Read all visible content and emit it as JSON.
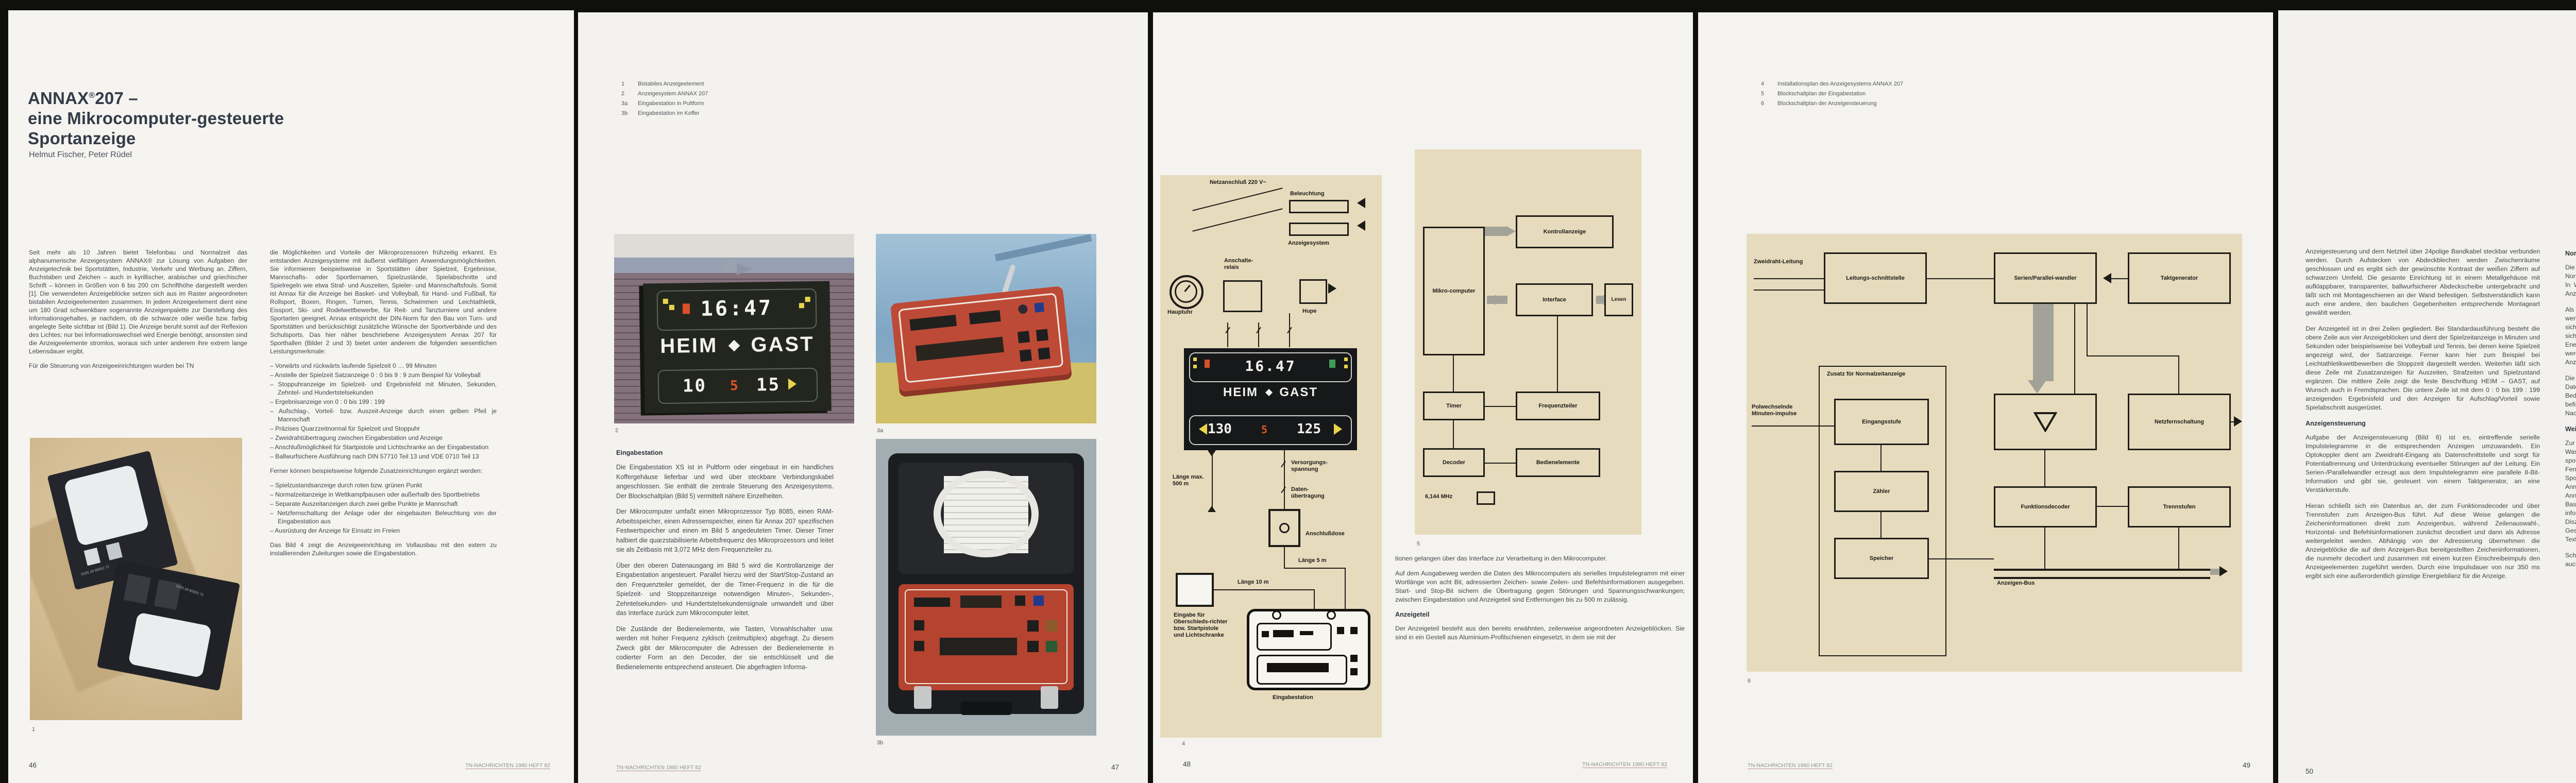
{
  "journal_footer": "TN-NACHRICHTEN 1980 HEFT 82",
  "colors": {
    "page_bg": "#f4f3f0",
    "diagram_bg": "#e7dbbd",
    "accent_yellow": "#e7d44a",
    "accent_red": "#d8502c",
    "accent_green": "#3f9e55",
    "console_red": "#b94a35",
    "bob_board_blue": "#2d4e8e",
    "body_text": "#42474d"
  },
  "p46": {
    "number": "46",
    "title": {
      "brand": "ANNAX",
      "reg": "®",
      "rest": "207 –",
      "line2": "eine Mikrocomputer-gesteuerte",
      "line3": "Sportanzeige"
    },
    "authors": "Helmut Fischer, Peter Rüdel",
    "col1": {
      "p1": "Seit mehr als 10 Jahren bietet Telefonbau und Normalzeit das alphanumerische Anzeigesystem ANNAX® zur Lösung von Aufgaben der Anzeigetechnik bei Sportstätten, Industrie, Verkehr und Werbung an. Ziffern, Buchstaben und Zeichen – auch in kyrillischer, arabischer und griechischer Schrift – können in Größen von 6 bis 200 cm Schrifthöhe dargestellt werden [1]. Die verwendeten Anzeigeblöcke setzen sich aus im Raster angeordneten bistabilen Anzeigeelementen zusammen. In jedem Anzeigeelement dient eine um 180 Grad schwenkbare sogenannte Anzeigenpalette zur Darstellung des Informationsgehaltes, je nachdem, ob die schwarze oder weiße bzw. farbig angelegte Seite sichtbar ist (Bild 1). Die Anzeige beruht somit auf der Reflexion des Lichtes; nur bei Informationswechsel wird Energie benötigt, ansonsten sind die Anzeigeelemente stromlos, woraus sich unter anderem ihre extrem lange Lebensdauer ergibt.",
      "p2": "Für die Steuerung von Anzeigeeinrichtungen wurden bei TN"
    },
    "fig1": {
      "caption": "1",
      "cube_label": "0165.18 90052 72"
    },
    "col2": {
      "p1": "die Möglichkeiten und Vorteile der Mikroprozessoren frühzeitig erkannt. Es entstanden Anzeigesysteme mit äußerst vielfältigen Anwendungsmöglichkeiten. Sie informieren beispielsweise in Sportstätten über Spielzeit, Ergebnisse, Mannschafts- oder Sportlernamen, Spielzustände, Spielabschnitte und Spielregeln wie etwa Straf- und Auszeiten, Spieler- und Mannschaftsfouls. Somit ist Annax für die Anzeige bei Basket- und Volleyball, für Hand- und Fußball, für Rollsport, Boxen, Ringen, Turnen, Tennis, Schwimmen und Leichtathletik, Eissport, Ski- und Rodelwettbewerbe, für Reit- und Tanzturniere und andere Sportarten geeignet. Annax entspricht der DIN-Norm für den Bau von Turn- und Sportstätten und berücksichtigt zusätzliche Wünsche der Sportverbände und des Schulsports. Das hier näher beschriebene Anzeigesystem Annax 207 für Sporthallen (Bilder 2 und 3) bietet unter anderem die folgenden wesentlichen Leistungsmerkmale:",
      "features": [
        "– Vorwärts und rückwärts laufende Spielzeit 0 … 99 Minuten",
        "– Anstelle der Spielzeit Satzanzeige 0 : 0 bis 9 : 9 zum Beispiel für Volleyball",
        "– Stoppuhranzeige im Spielzeit- und Ergebnisfeld mit Minuten, Sekunden, Zehntel- und Hundertstelsekunden",
        "– Ergebnisanzeige von 0 : 0 bis 199 : 199",
        "– Aufschlag-, Vorteil- bzw. Auszeit-Anzeige durch einen gelben Pfeil je Mannschaft",
        "– Präzises Quarzzeitnormal für Spielzeit und Stoppuhr",
        "– Zweidrahtübertragung zwischen Eingabestation und Anzeige",
        "– Anschlußmöglichkeit für Startpistole und Lichtschranke an der Eingabestation",
        "– Ballwurfsichere Ausführung nach DIN 57710 Teil 13 und VDE 0710 Teil 13"
      ],
      "mid": "Ferner können beispielsweise folgende Zusatzeinrichtungen ergänzt werden:",
      "extras": [
        "– Spielzustandsanzeige durch roten bzw. grünen Punkt",
        "– Normalzeitanzeige in Wettkampfpausen oder außerhalb des Sportbetriebs",
        "– Separate Auszeitanzeigen durch zwei gelbe Punkte je Mannschaft",
        "– Netzfernschaltung der Anlage oder der eingebauten Beleuchtung von der Eingabestation aus",
        "– Ausrüstung der Anzeige für Einsatz im Freien"
      ],
      "last": "Das Bild 4 zeigt die Anzeigeeinrichtung im Vollausbau mit den extern zu installierenden Zuleitungen sowie die Eingabestation."
    }
  },
  "p47": {
    "number": "47",
    "captions": [
      {
        "num": "1",
        "text": "Bistabiles Anzeigeelement"
      },
      {
        "num": "2",
        "text": "Anzeigesystem ANNAX 207"
      },
      {
        "num": "3a",
        "text": "Eingabestation in Pultform"
      },
      {
        "num": "3b",
        "text": "Eingabestation im Koffer"
      }
    ],
    "fig2": {
      "caption": "2",
      "time": "16:47",
      "heim": "HEIM",
      "gast": "GAST",
      "s1": "10",
      "mid": "5",
      "s2": "15"
    },
    "fig3a": {
      "caption": "3a"
    },
    "fig3b": {
      "caption": "3b"
    },
    "heading": "Eingabestation",
    "col": {
      "p1": "Die Eingabestation XS ist in Pultform oder eingebaut in ein handliches Koffergehäuse lieferbar und wird über steckbare Verbindungskabel angeschlossen. Sie enthält die zentrale Steuerung des Anzeigesystems. Der Blockschaltplan (Bild 5) vermittelt nähere Einzelheiten.",
      "p2": "Der Mikrocomputer umfaßt einen Mikroprozessor Typ 8085, einen RAM-Arbeitsspeicher, einen Adressenspeicher, einen für Annax 207 spezifischen Festwertspeicher und einen im Bild 5 angedeuteten Timer. Dieser Timer halbiert die quarzstabilisierte Arbeitsfrequenz des Mikroprozessors und leitet sie als Zeitbasis mit 3,072 MHz dem Frequenzteiler zu.",
      "p3": "Über den oberen Datenausgang im Bild 5 wird die Kontrollanzeige der Eingabestation angesteuert. Parallel hierzu wird der Start/Stop-Zustand an den Frequenzteiler gemeldet, der die Timer-Frequenz in die für die Spielzeit- und Stoppzeitanzeige notwendigen Minuten-, Sekunden-, Zehntelsekunden- und Hundertstelsekundensignale umwandelt und über das Interface zurück zum Mikrocomputer leitet.",
      "p4": "Die Zustände der Bedienelemente, wie Tasten, Vorwahlschalter usw. werden mit hoher Frequenz zyklisch (zeitmultiplex) abgefragt. Zu diesem Zweck gibt der Mikrocomputer die Adressen der Bedienelemente in codierter Form an den Decoder, der sie entschlüsselt und die Bedienelemente entsprechend ansteuert. Die abgefragten Informa-"
    }
  },
  "p48": {
    "number": "48",
    "fig4": {
      "caption": "4",
      "netz": "Netzanschluß 220 V~",
      "beleuchtung": "Beleuchtung",
      "anzeigesystem": "Anzeigesystem",
      "relais": "Anschalte-relais",
      "hupe": "Hupe",
      "hauptuhr": "Hauptuhr",
      "board": {
        "clock": "16.47",
        "heim": "HEIM",
        "gast": "GAST",
        "s1": "130",
        "mid": "5",
        "s2": "125"
      },
      "laenge500": "Länge max. 500 m",
      "versorgung": "Versorgungs-spannung",
      "daten": "Daten-übertragung",
      "dose": "Anschlußdose",
      "laenge5": "Länge 5 m",
      "laenge10": "Länge 10 m",
      "eingabe": "Eingabe für Oberschieds-richter bzw. Startpistole und Lichtschranke",
      "station": "Eingabestation"
    },
    "fig5": {
      "caption": "5",
      "mikro": "Mikro-computer",
      "kontroll": "Kontrollanzeige",
      "interface": "Interface",
      "lesen": "Lesen",
      "timer": "Timer",
      "freq": "Frequenzteiler",
      "decoder": "Decoder",
      "bedien": "Bedienelemente",
      "quartz": "6,144 MHz"
    },
    "col": {
      "cont": "tionen gelangen über das Interface zur Verarbeitung in den Mikrocomputer.",
      "p2": "Auf dem Ausgabeweg werden die Daten des Mikrocomputers als serielles Impulstelegramm mit einer Wortlänge von acht Bit, adressierten Zeichen- sowie Zeilen- und Befehlsinformationen ausgegeben. Start- und Stop-Bit sichern die Übertragung gegen Störungen und Spannungsschwankungen; zwischen Eingabestation und Anzeigeteil sind Entfernungen bis zu 500 m zulässig.",
      "heading": "Anzeigeteil",
      "p3": "Der Anzeigeteil besteht aus den bereits erwähnten, zeilenweise angeordneten Anzeigeblöcken. Sie sind in ein Gestell aus Aluminium-Profilschienen eingesetzt, in dem sie mit der"
    }
  },
  "p49": {
    "number": "49",
    "captions": [
      {
        "num": "4",
        "text": "Installationsplan des Anzeigesystems ANNAX 207"
      },
      {
        "num": "5",
        "text": "Blockschaltplan der Eingabestation"
      },
      {
        "num": "6",
        "text": "Blockschaltplan der Anzeigensteuerung"
      }
    ],
    "fig6": {
      "caption": "6",
      "zweidraht": "Zweidraht-Leitung",
      "schnittstelle": "Leitungs-schnittstelle",
      "wandler": "Serien/Parallel-wandler",
      "takt": "Taktgenerator",
      "netzfern": "Netzfernschaltung",
      "zusatz": "Zusatz für Normalzeitanzeige",
      "minuten": "Polwechselnde Minuten-impulse",
      "eingang": "Eingangsstufe",
      "zaehler": "Zähler",
      "speicher": "Speicher",
      "funk": "Funktionsdecoder",
      "trenn": "Trennstufen",
      "bus": "Anzeigen-Bus"
    }
  },
  "p50": {
    "number": "50",
    "col1": {
      "p1": "Anzeigesteuerung und dem Netzteil über 24polige Bandkabel steckbar verbunden werden. Durch Aufstecken von Abdeckblechen werden Zwischenräume geschlossen und es ergibt sich der gewünschte Kontrast der weißen Ziffern auf schwarzem Umfeld. Die gesamte Einrichtung ist in einem Metallgehäuse mit aufklappbarer, transparenter, ballwurfsicherer Abdeckscheibe untergebracht und läßt sich mit Montageschienen an der Wand befestigen. Selbstverständlich kann auch eine andere, den baulichen Gegebenheiten entsprechende Montageart gewählt werden.",
      "p2": "Der Anzeigeteil ist in drei Zeilen gegliedert. Bei Standardausführung besteht die obere Zeile aus vier Anzeigeblöcken und dient der Spielzeitanzeige in Minuten und Sekunden oder beispielsweise bei Volleyball und Tennis, bei denen keine Spielzeit angezeigt wird, der Satzanzeige. Ferner kann hier zum Beispiel bei Leichtathletikwettbewerben die Stoppzeit dargestellt werden. Weiterhin läßt sich diese Zeile mit Zusatzanzeigen für Auszeiten, Strafzeiten und Spielzustand ergänzen. Die mittlere Zeile zeigt die feste Beschriftung HEIM – GAST, auf Wunsch auch in Fremdsprachen. Die untere Zeile ist mit dem 0 : 0 bis 199 : 199 anzeigenden Ergebnisfeld und den Anzeigen für Aufschlag/Vorteil sowie Spielabschnitt ausgerüstet.",
      "heading": "Anzeigensteuerung",
      "p3": "Aufgabe der Anzeigensteuerung (Bild 6) ist es, eintreffende serielle Impulstelegramme in die entsprechenden Anzeigen umzuwandeln. Ein Optokoppler dient am Zweidraht-Eingang als Datenschnittstelle und sorgt für Potentialtrennung und Unterdrückung eventueller Störungen auf der Leitung. Ein Serien-/Parallelwandler erzeugt aus dem Impulstelegramm eine parallele 8-Bit-Information und gibt sie, gesteuert von einem Taktgenerator, an eine Verstärkerstufe.",
      "p4": "Hieran schließt sich ein Datenbus an, der zum Funktionsdecoder und über Trennstufen zum Anzeigen-Bus führt. Auf diese Weise gelangen die Zeicheninformationen direkt zum Anzeigenbus, während Zeilenauswahl-, Horizontal- und Befehlsinformationen zunächst decodiert und dann als Adresse weitergeleitet werden. Abhängig von der Adressierung übernehmen die Anzeigeblöcke die auf dem Anzeigen-Bus bereitgestellten Zeicheninformationen, die nunmehr decodiert und zusammen mit einem kurzen Einschreibeimpuls den Anzeigeelementen zugeführt werden. Durch eine Impulsdauer von nur 350 ms ergibt sich eine außerordentlich günstige Energiebilanz für die Anzeige."
    },
    "col2": {
      "heading1": "Normalzeitanzeige",
      "p1": "Die Anzeigensteuerung kann bei Bedarf mit einem Zusatz für die Normalzeitanzeige in Form einer steckbaren Leiterplatte ergänzt werden (Bild 6). In Wettbewerbspausen oder außerhalb des Sportbetriebs ist damit die digitale Anzeige der Uhrzeit in Stunden und Minuten in der oberen Anzeigezeile möglich.",
      "p2": "Als Eingangssignal sind polwechselnde Minutenimpulse einer Hauptuhr von wenigstens 300 ms Dauer erforderlich. Der Eingang der Zusatz-Leiterplatte läßt sich auf alle gängigen Impulsspannungen zwischen 12 und 60 V anpassen. Der sich anschließende Zähler- und Speicherteil hat einen so geringen Energieverbrauch, daß er von den ständig einlaufenden Minutenimpulsen gespeist werden kann und somit auch bei Netzausfall und Abschaltung des Anzeigesystems in Funktion ist und die Normalzeitdaten ständig erhalten bleiben.",
      "p3": "Die Steuerinformationen gelangen über Trenn- und Verstärkerstufen auf den Datenbus und über den schon beschriebenen Weg zum Anzeigeteil. Bedienelemente zum Nachstellen der Anzeige und zum Löschen (Nullstellen) befinden sich auf der Leiterplatte. Auf Wunsch kann eine externe Nachstelleinrichtung vorgesehen werden.",
      "heading2": "Weitere TN-Anzeigesysteme",
      "p4": "Zur Baureihe des Anzeigesystems Annax 207 gehören auch die Sportanzeigen für Wasserball 207 W und 207 WS, die sich vom beschriebenen Typ durch speziellen, sportregelgerechten Ausbau und die spezifische Programmierung unterscheiden. Ferner sei das im vergangenen Oktober auf der 8. Internationalen Ausstellung Sportstättenbau und Bäderanlagen in Köln erstmals vorgestellte Anzeigesystem Annax 220 erwähnt. Dieses System ist eine Ergänzung und Weiterentwicklung des Annax 207, mit dem Anzeigen für weitere Sportarten, zum Beispiel Eishockey, Basketball, Volleyball, Handball, Tennis und viele andere, komfortabel und noch informativer zu realisieren sind. Beispielsweise können bis zu acht Straf- bzw. Disziplinarzeiten oder Spielernummern und Strafzeiten, fünf Satzergebnisse, Gesamtfouls je Mannschaft, persönliche Fouls, sowie beliebige alphanumerische Texte angezeigt werden.",
      "p5": "Schließlich sei noch erwähnt, daß die Anlagen der Baureihe Annax grundsätzlich auch mit sogenannten Leuchtkammer-"
    }
  },
  "p51": {
    "number": "51",
    "captions": [
      {
        "num": "7",
        "text": "Anzeigesystem ANNAX bei Bob- und Rennrodelwettbewerben"
      },
      {
        "num": "8",
        "text": "Großanzeige für LKW-Beladung"
      }
    ],
    "fig7": {
      "caption": "7",
      "sign": {
        "line1": "„Frisch vom Faß.",
        "line2": "Veltins.“",
        "brand": "VELTINS",
        "sub": "PILSENER"
      },
      "rows": [
        {
          "label": "Nation",
          "value": "GER 2"
        },
        {
          "label": "Startnummer",
          "value": "01"
        },
        {
          "label": "Zeit",
          "value": "0:57.03"
        },
        {
          "label": "Total",
          "value": "1:34.78"
        },
        {
          "label": "Rang",
          "value": "03"
        }
      ],
      "snowflake": "❄"
    },
    "fig8": {
      "caption": "8",
      "header_left": "KFZ-KENNZEICHEN",
      "header_right": "SPUR",
      "rows": [
        "GG -VA 918   4",
        "FD -N  162   6",
        "LAT-V  89   18"
      ]
    },
    "left_para": "anzeigen, das heißt mit glühlampenbestückten, selbstleuchtenden Anzeigeblöcken ausgerüstet werden können. Alle Vorzüge der einfachen und zweckmäßigen Bedienung bleiben auch bei dieser Technik voll erhalten.",
    "col2": {
      "heading": "Zusammenfassung",
      "p1": "Die wesentlichen Merkmale des Mikrocomputer-gesteuerten Anzeigesystems Annax 207 für Sportstätten sind neben der Zweidraht-Übertragung der Informationen zwischen Eingabestation und Anzeigeteil die vielfältigen Programmiermöglichkeiten für verschiedenartige Leistungsmerkmale und sportregelgerechte Zeit- und Spielstandanzeigen (Bild 7). Steuer- und Anzeigeteil sind in Modulbauweise mit steckbaren Baugruppen ausgeführt. Die gleichen Baugruppen finden auch in Anzeigesystemen für andere Zwecke in den Bereichen Industrie, Verkehr und Werbung Verwendung (Bild 8).",
      "p2": "Der übersichtliche, gut zugängliche Aufbau des Anzeigeteils in leichtem, ballwurfsicheren Gehäuse und die transportable Eingabestation in Pultform oder im Koffergehäuse ermöglichen problemlose Montage, bequeme Bedienung und zügige Wartung. Zusatzeinrichtungen runden das Lieferprogramm ab."
    },
    "lit_label": "Literatur:",
    "lit_entry": "[1] Ludes, R.; Rüdel, P.: Ein Anzeigesystem nach dem Baukastenprinzip mit bistabilen Anzeigeelementen. TN-Nachrichten (1975) 76, S. 49-55."
  }
}
